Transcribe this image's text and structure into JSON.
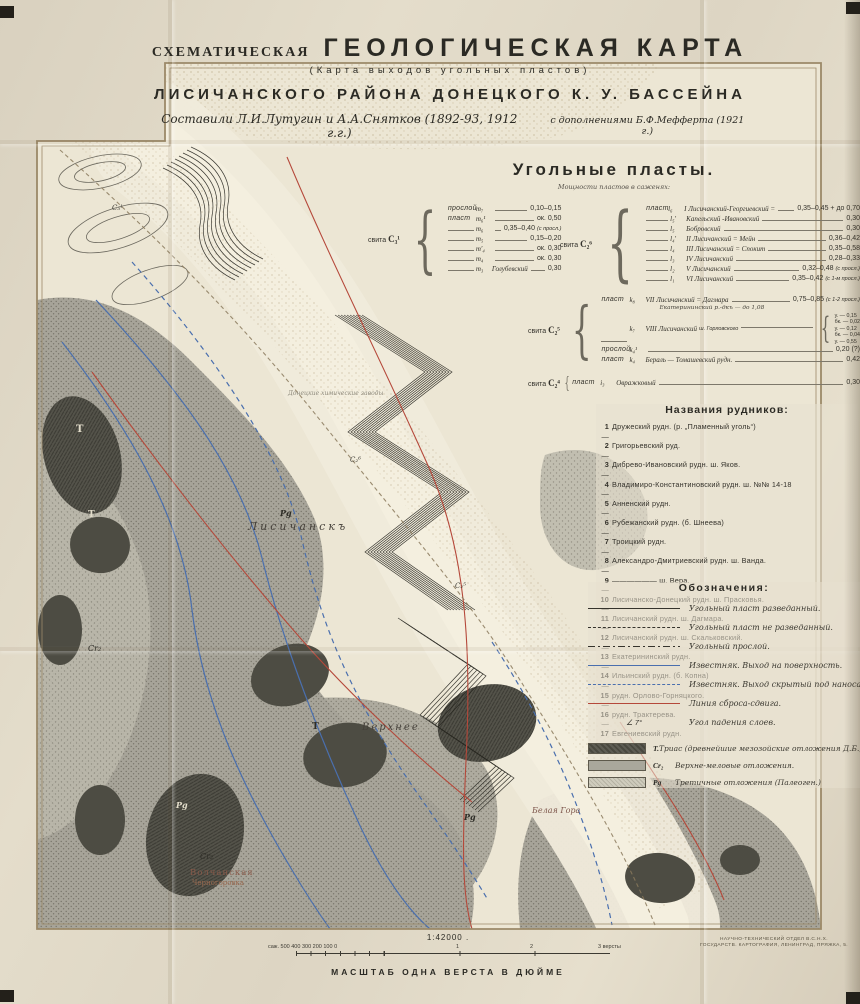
{
  "title": {
    "prefix": "СХЕМАТИЧЕСКАЯ",
    "main": "ГЕОЛОГИЧЕСКАЯ  КАРТА",
    "subtitle": "(Карта выходов угольных пластов)",
    "region": "ЛИСИЧАНСКОГО  РАЙОНА  ДОНЕЦКОГО  К. У.  БАССЕЙНА",
    "authors": "Составили  Л.И.Лутугин и А.А.Снятков  (1892-93, 1912 г.г.)",
    "addition": "с дополнениями Б.Ф.Мефферта (1921 г.)"
  },
  "seams": {
    "heading": "Угольные  пласты.",
    "subheading": "Мощности пластов в саженях:",
    "suite_m": "свита",
    "suite_m_code": "C₃¹",
    "suite_l": "свита",
    "suite_l_code": "C₂⁶",
    "suite_k": "свита",
    "suite_k_code": "C₂⁵",
    "suite_i": "свита",
    "suite_i_code": "C₂⁴",
    "m_rows": [
      {
        "k": "прослой",
        "i": "m₇",
        "n": "",
        "v": "0,10–0,15",
        "note": ""
      },
      {
        "k": "пласт",
        "i": "m₆¹",
        "n": "",
        "v": "ок. 0,50",
        "note": ""
      },
      {
        "k": "",
        "i": "m₆",
        "n": "",
        "v": "0,35–0,40",
        "note": "(с просл.)"
      },
      {
        "k": "",
        "i": "m₅",
        "n": "",
        "v": "0,15–0,20",
        "note": ""
      },
      {
        "k": "",
        "i": "m′₄",
        "n": "",
        "v": "ок. 0,30",
        "note": ""
      },
      {
        "k": "",
        "i": "m₄",
        "n": "",
        "v": "ок. 0,30",
        "note": ""
      },
      {
        "k": "",
        "i": "m₃",
        "n": "Голубевский",
        "v": "0,30",
        "note": ""
      }
    ],
    "l_rows": [
      {
        "k": "пласт",
        "i": "l₆",
        "n": "I Лисичанский-Георгиевский =",
        "v": "0,35–0,45 + до 0,70",
        "note": ""
      },
      {
        "k": "",
        "i": "l₅′",
        "n": "Капельский -Ивановский",
        "v": "0,30",
        "note": ""
      },
      {
        "k": "",
        "i": "l₅",
        "n": "Бобровский",
        "v": "0,30",
        "note": ""
      },
      {
        "k": "",
        "i": "l₄′",
        "n": "II Лисичанский = Мейн",
        "v": "0,36–0,42",
        "note": ""
      },
      {
        "k": "",
        "i": "l₄",
        "n": "III Лисичанский = Спокит",
        "v": "0,35–0,58",
        "note": ""
      },
      {
        "k": "",
        "i": "l₃",
        "n": "IV Лисичанский",
        "v": "0,28–0,33",
        "note": ""
      },
      {
        "k": "",
        "i": "l₂",
        "n": "V Лисичанский",
        "v": "0,32–0,48",
        "note": "(с просл.)"
      },
      {
        "k": "",
        "i": "l₁",
        "n": "VI Лисичанский",
        "v": "0,35–0,42",
        "note": "(с 1-м просл.)"
      }
    ],
    "k_rows": [
      {
        "k": "пласт",
        "i": "k₈",
        "n": "VII Лисичанский = Дагмара",
        "v": "0,75–0,85",
        "note": "(с 1-2 просл.)",
        "sub": "Екатерининский р.-дкъ — до 1,08"
      },
      {
        "k": "",
        "i": "k₇",
        "n": "VIII Лисичанский",
        "note": "ш. Горловского",
        "stack": [
          "у. — 0,15",
          "бк. — 0,02",
          "у. — 0,12",
          "бк. — 0,04",
          "у. — 0,55"
        ]
      },
      {
        "k": "прослой",
        "i": "k₄¹",
        "n": "",
        "v": "0,20 (?)",
        "note": ""
      },
      {
        "k": "пласт",
        "i": "k₄",
        "n": "Бераль — Томашевский рудн.",
        "v": "0,42",
        "note": ""
      }
    ],
    "i_rows": [
      {
        "k": "пласт",
        "i": "i₃",
        "n": "Овражковый",
        "v": "0,30",
        "note": ""
      }
    ]
  },
  "mines": {
    "heading": "Названия рудников:",
    "items": [
      {
        "num": "1",
        "text": "Дружеский рудн. (р. „Пламенный уголь“)"
      },
      {
        "num": "2",
        "text": "Григорьевский руд."
      },
      {
        "num": "3",
        "text": "Дибрево-Ивановский рудн. ш. Яков."
      },
      {
        "num": "4",
        "text": "Владимиро-Константиновский рудн. ш. №№ 14-18"
      },
      {
        "num": "5",
        "text": "Анненский рудн."
      },
      {
        "num": "6",
        "text": "Рубежанский рудн. (б. Шнеева)"
      },
      {
        "num": "7",
        "text": "Троицкий рудн."
      },
      {
        "num": "8",
        "text": "Александро-Дмитриевский рудн. ш. Ванда."
      },
      {
        "num": "9",
        "text": "—————— ш. Вера."
      },
      {
        "num": "10",
        "text": "Лисичанско-Донецкий рудн. ш. Прасковья."
      },
      {
        "num": "11",
        "text": "Лисичанский рудн. ш. Дагмара."
      },
      {
        "num": "12",
        "text": "Лисичанский рудн. ш. Скальковский."
      },
      {
        "num": "13",
        "text": "Екатерининский рудн."
      },
      {
        "num": "14",
        "text": "Ильинский рудн. (б. Копна)"
      },
      {
        "num": "15",
        "text": "рудн. Орлово-Горняцкого."
      },
      {
        "num": "16",
        "text": "рудн. Трактерева."
      },
      {
        "num": "17",
        "text": "Евгениевский рудн."
      }
    ]
  },
  "symbols": {
    "heading": "Обозначения:",
    "items": [
      {
        "label": "Угольный пласт разведанный."
      },
      {
        "label": "Угольный пласт не разведанный."
      },
      {
        "label": "Угольный прослой."
      },
      {
        "label": "Известняк. Выход на поверхность."
      },
      {
        "label": "Известняк. Выход скрытый под наносами."
      },
      {
        "label": "Линия сброса-сдвига."
      },
      {
        "sym": "∠ 7°",
        "label": "Угол падения слоев."
      }
    ],
    "strata": [
      {
        "code": "Т.",
        "label": "Триас (древнейшие мезозойские отложения Д.Б.)"
      },
      {
        "code": "Cr₂",
        "label": "Верхне-меловые отложения."
      },
      {
        "code": "Pg",
        "label": "Третичные отложения (Палеоген.)"
      }
    ]
  },
  "scale": {
    "ratio": "1:42000 .",
    "bar_left": "саж. 500 400 300 200 100  0",
    "t1": "1",
    "t2": "2",
    "t3": "3 версты",
    "caption": "МАСШТАБ  ОДНА  ВЕРСТА  В ДЮЙМЕ"
  },
  "imprint": {
    "line1": "НАУЧНО-ТЕХНИЧЕСКИЙ ОТДЕЛ В.С.Н.Х.",
    "line2": "ГОСУДАРСТВ. КАРТОГРАФИЯ, ЛЕНИНГРАД, ПРЯЖКА, 5."
  },
  "map_labels": [
    {
      "text": "Лисичанскъ"
    },
    {
      "text": "Верхнее"
    },
    {
      "text": "Волчанская"
    },
    {
      "text": "Черногоровка"
    },
    {
      "text": "Белая Гора"
    },
    {
      "text": "Донецкие химические заводы"
    },
    {
      "text": "Т"
    },
    {
      "text": "Т"
    },
    {
      "text": "Т"
    },
    {
      "text": "Pg"
    },
    {
      "text": "Pg"
    },
    {
      "text": "Pg"
    },
    {
      "text": "Cr₂"
    },
    {
      "text": "Cr₂"
    },
    {
      "text": "C₃¹"
    },
    {
      "text": "C₂⁶"
    },
    {
      "text": "C₂⁵"
    }
  ],
  "colors": {
    "limestone_blue": "#4a6fae",
    "fault_red": "#b5483a",
    "paper": "#ece6d4",
    "frame": "#9b8968"
  }
}
